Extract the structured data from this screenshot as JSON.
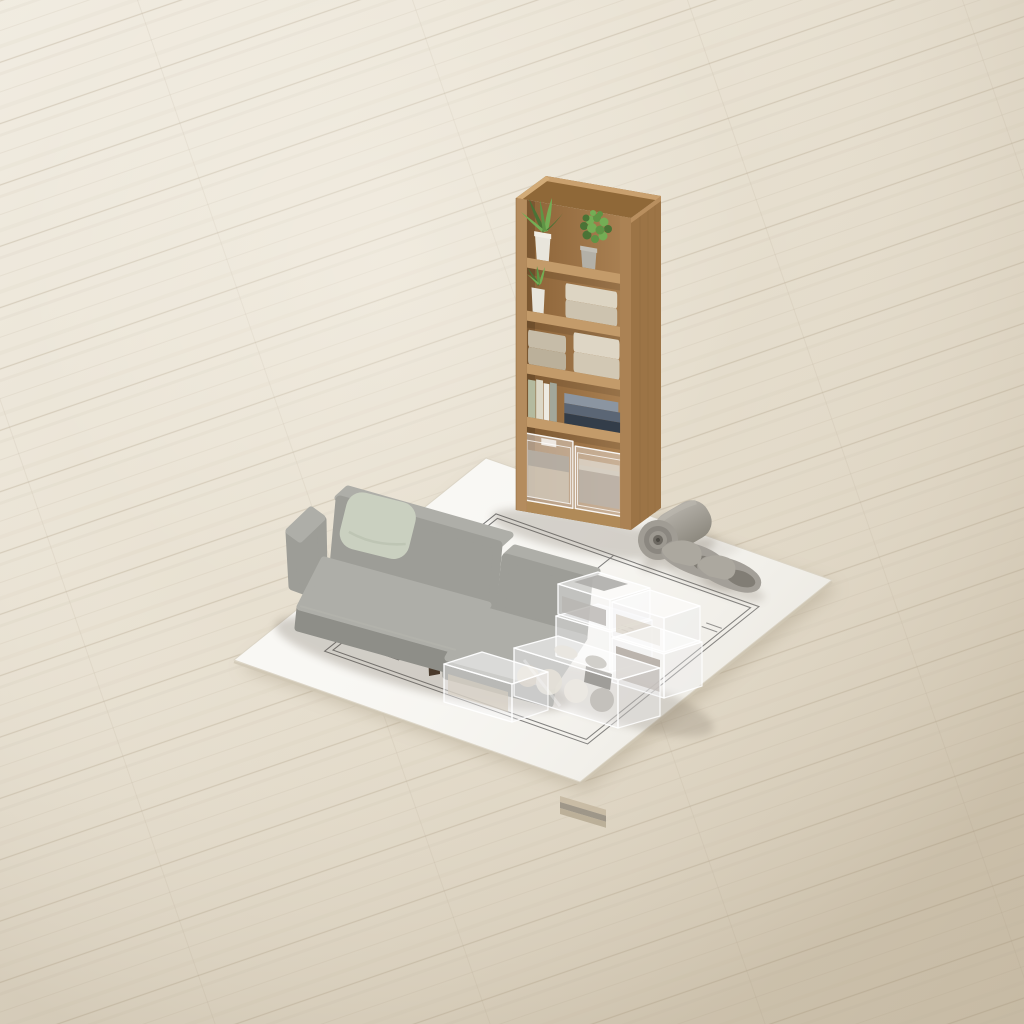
{
  "meta": {
    "description": "Isometric 3D render of miniature furniture staged on a white floor-plan sheet lying on a pale wooden floor: a tall oak shelf holding potted plants, folded towels, books and clear drawers; a grey fabric sofa with chaise and a pale green cushion; stacked transparent storage boxes filled with folded textiles; a rolled grey mat and a pair of grey slippers."
  },
  "palette": {
    "floor_light": "#f0ebe0",
    "floor_dark": "#d5cab6",
    "paper": "#f9f8f4",
    "plan_line": "#6d6d6d",
    "wood_front": "#b48c5e",
    "wood_side": "#9c7446",
    "wood_rim": "#c9a06e",
    "wood_interior": "#9c744a",
    "wood_shelf_board": "#c39b6a",
    "sofa_fabric": "#9d9d97",
    "sofa_light": "#aeaea8",
    "sofa_dark": "#8e8e88",
    "pillow": "#cad0c0",
    "leg_wood": "#4a3a2c",
    "plant_dark": "#4a7336",
    "plant_light": "#74ad55",
    "pot_white": "#e8e5dc",
    "pot_grey": "#b3b0a7",
    "towel_beige": "#d8cfbc",
    "towel_dark": "#c0b5a0",
    "book_navy": "#333d49",
    "book_blue": "#8b95a1",
    "book_sage": "#b4ba9f",
    "textile_grey": "#9b968c",
    "textile_cream": "#d9d2c2",
    "textile_brown": "#8a7a66",
    "slipper_grey": "#a39f98",
    "mat_grey": "#a7a39b",
    "shadow": "#6e6354"
  },
  "objects": {
    "floor": {
      "label": "pale wood plank floor"
    },
    "paper": {
      "label": "white floor-plan sheet"
    },
    "floor_plan": {
      "label": "architectural floor plan drawing"
    },
    "shelf": {
      "label": "tall oak shelf unit"
    },
    "plants": {
      "label": "potted green plants"
    },
    "towels": {
      "label": "folded beige towels"
    },
    "books": {
      "label": "stacked and upright books"
    },
    "shelf_drawers": {
      "label": "clear drawer boxes on bottom shelf"
    },
    "sofa": {
      "label": "grey fabric sofa with chaise"
    },
    "pillow": {
      "label": "pale green throw pillow"
    },
    "storage_boxes": {
      "label": "stacked clear storage boxes with folded textiles"
    },
    "under_sofa_box": {
      "label": "clear storage box under chaise"
    },
    "mat_roll": {
      "label": "rolled grey mat"
    },
    "slippers": {
      "label": "pair of grey slippers"
    }
  }
}
